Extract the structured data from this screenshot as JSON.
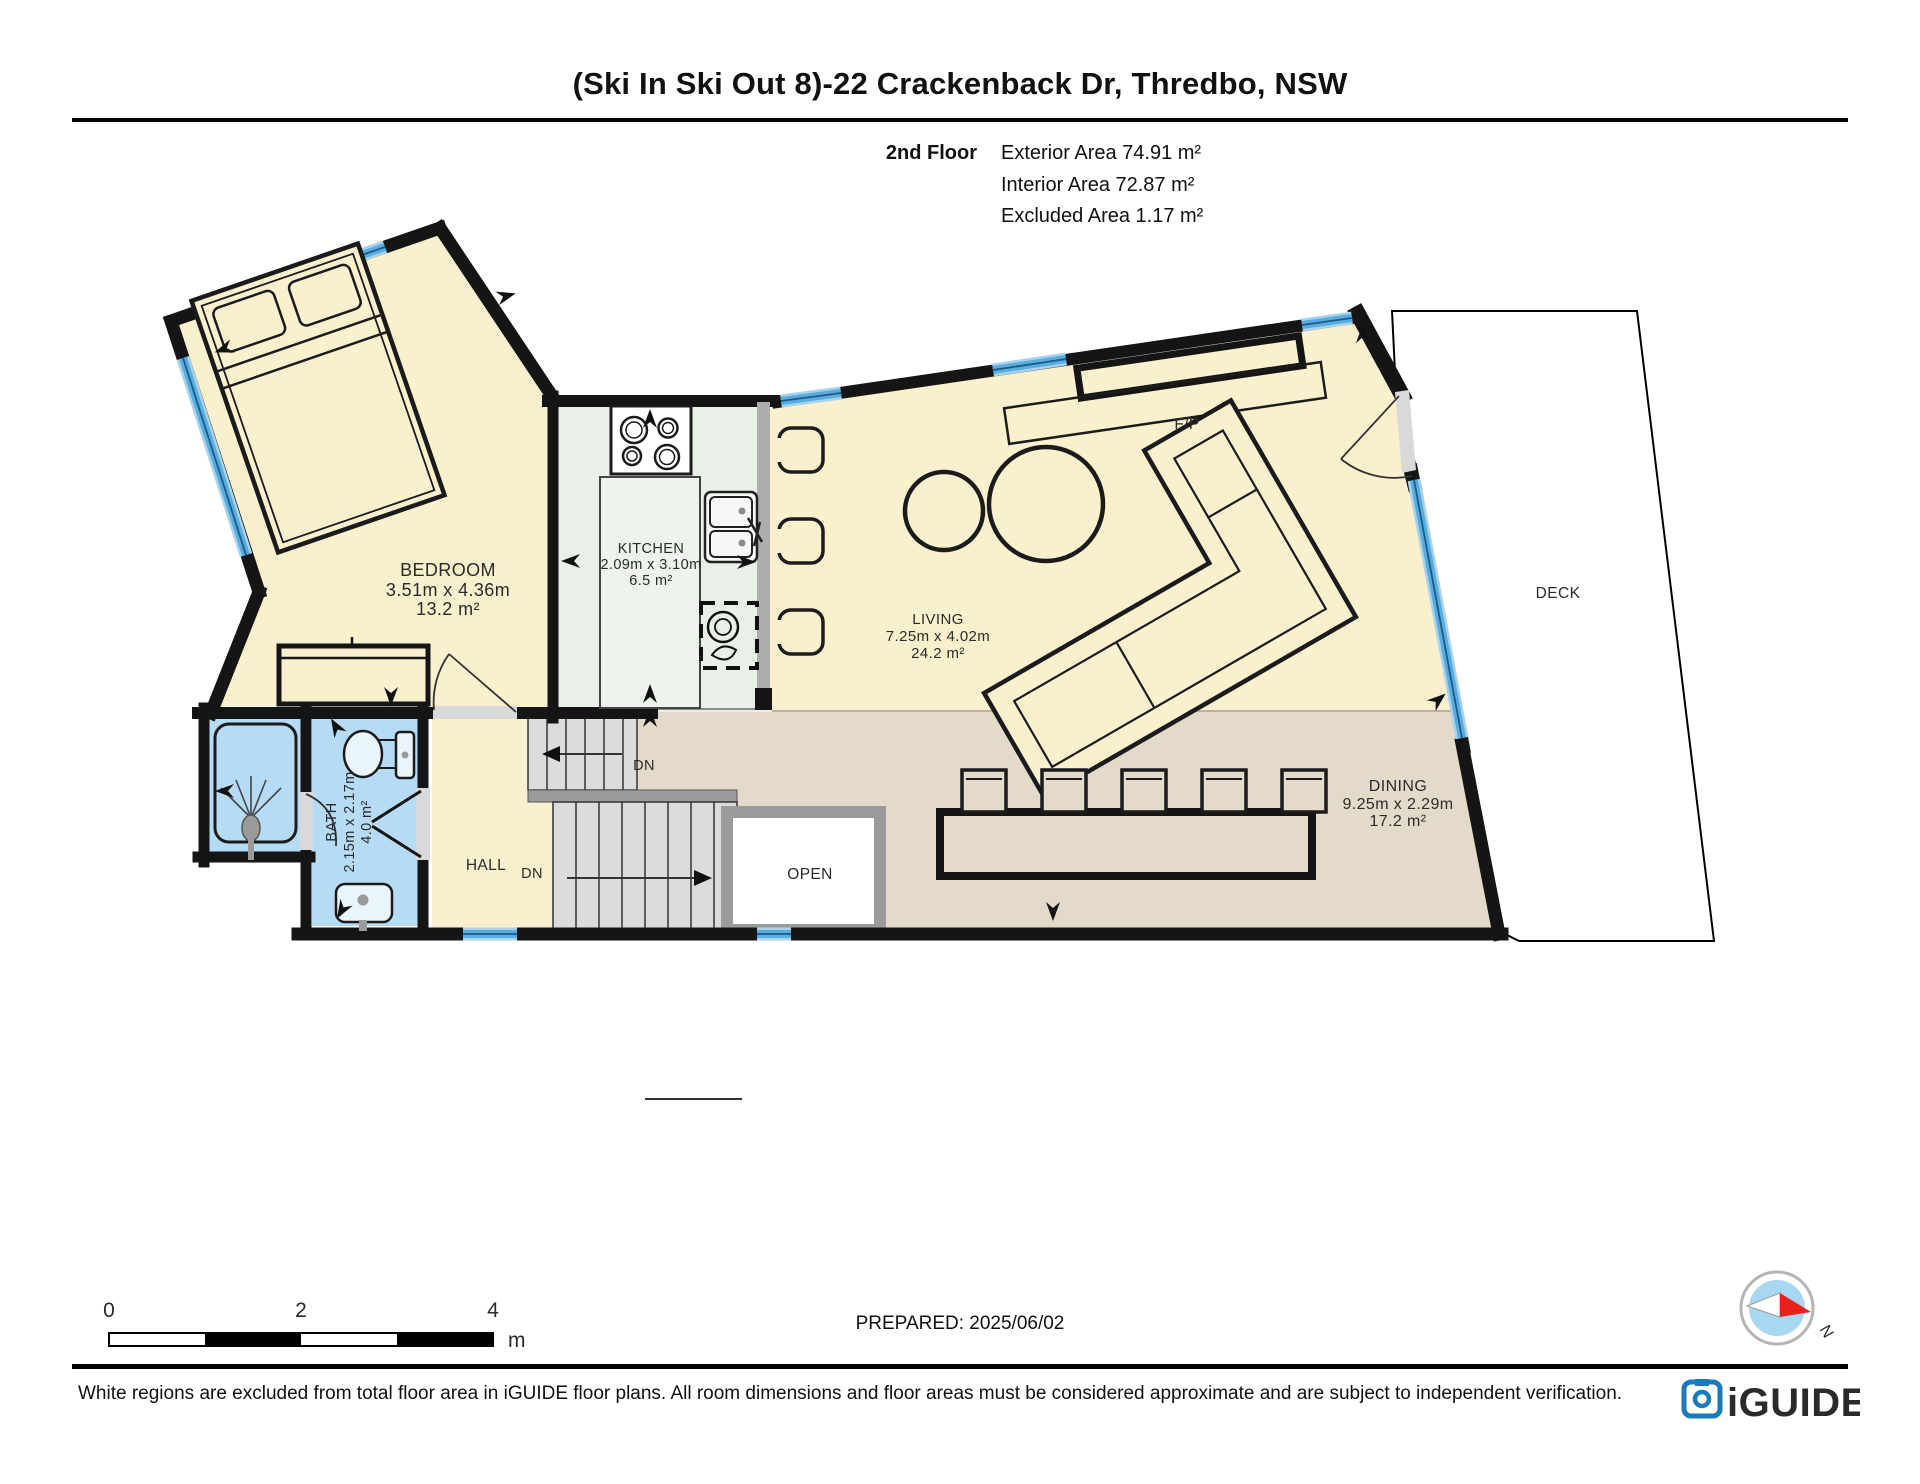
{
  "header": {
    "title": "(Ski In Ski Out 8)-22 Crackenback Dr, Thredbo, NSW",
    "floor_label": "2nd Floor",
    "exterior_area": "Exterior Area 74.91 m²",
    "interior_area": "Interior Area 72.87 m²",
    "excluded_area": "Excluded Area 1.17 m²"
  },
  "rooms": {
    "bedroom": {
      "name": "BEDROOM",
      "dims": "3.51m x 4.36m",
      "area": "13.2 m²"
    },
    "kitchen": {
      "name": "KITCHEN",
      "dims": "2.09m x 3.10m",
      "area": "6.5 m²"
    },
    "living": {
      "name": "LIVING",
      "dims": "7.25m x 4.02m",
      "area": "24.2 m²"
    },
    "dining": {
      "name": "DINING",
      "dims": "9.25m x 2.29m",
      "area": "17.2 m²"
    },
    "bath": {
      "name": "BATH",
      "dims": "2.15m x 2.17m",
      "area": "4.0 m²"
    },
    "hall": {
      "name": "HALL"
    },
    "open": {
      "name": "OPEN"
    },
    "deck": {
      "name": "DECK"
    },
    "fireplace": {
      "name": "F/P"
    },
    "stairs_down_upper": "DN",
    "stairs_down_lower": "DN"
  },
  "footer": {
    "scale": {
      "tick0": "0",
      "tick2": "2",
      "tick4": "4",
      "unit": "m"
    },
    "prepared": "PREPARED: 2025/06/02",
    "disclaimer": "White regions are excluded from total floor area in iGUIDE floor plans. All room dimensions and floor areas must be considered approximate and are subject to independent verification.",
    "compass_north": "N",
    "brand": "iGUIDE"
  },
  "colors": {
    "room_cream": "#FAF0CE",
    "kitchen_green": "#E9F0E7",
    "dining_tan": "#E4DACA",
    "bath_blue": "#B5DBF5",
    "window_blue": "#57ACE0",
    "wall_black": "#151515",
    "brand_blue": "#1A7ABB",
    "compass_red": "#E8211D"
  }
}
